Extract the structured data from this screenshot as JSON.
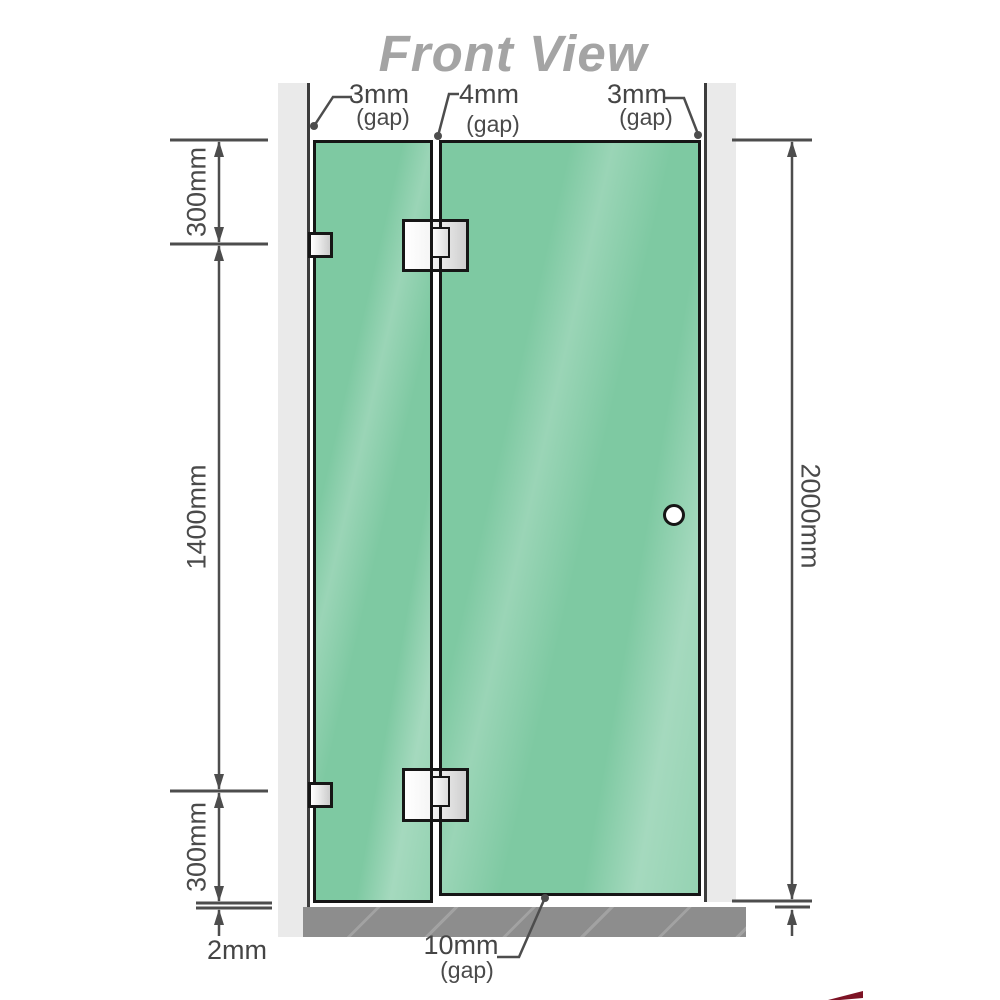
{
  "title": "Front View",
  "labels": {
    "gap_left": {
      "value": "3mm",
      "suffix": "(gap)"
    },
    "gap_middle": {
      "value": "4mm",
      "suffix": "(gap)"
    },
    "gap_right": {
      "value": "3mm",
      "suffix": "(gap)"
    },
    "dim_top": "300mm",
    "dim_middle": "1400mm",
    "dim_bottom": "300mm",
    "dim_right": "2000mm",
    "floor_gap_left": "2mm",
    "floor_gap_door": {
      "value": "10mm",
      "suffix": "(gap)"
    }
  },
  "colors": {
    "glass_green": "#7ec9a2",
    "wall_gray": "#eaeaea",
    "floor_gray": "#8d8d8d",
    "line_gray": "#4d4d4d",
    "title_gray": "#a4a4a4",
    "accent_red": "#7d1325"
  }
}
